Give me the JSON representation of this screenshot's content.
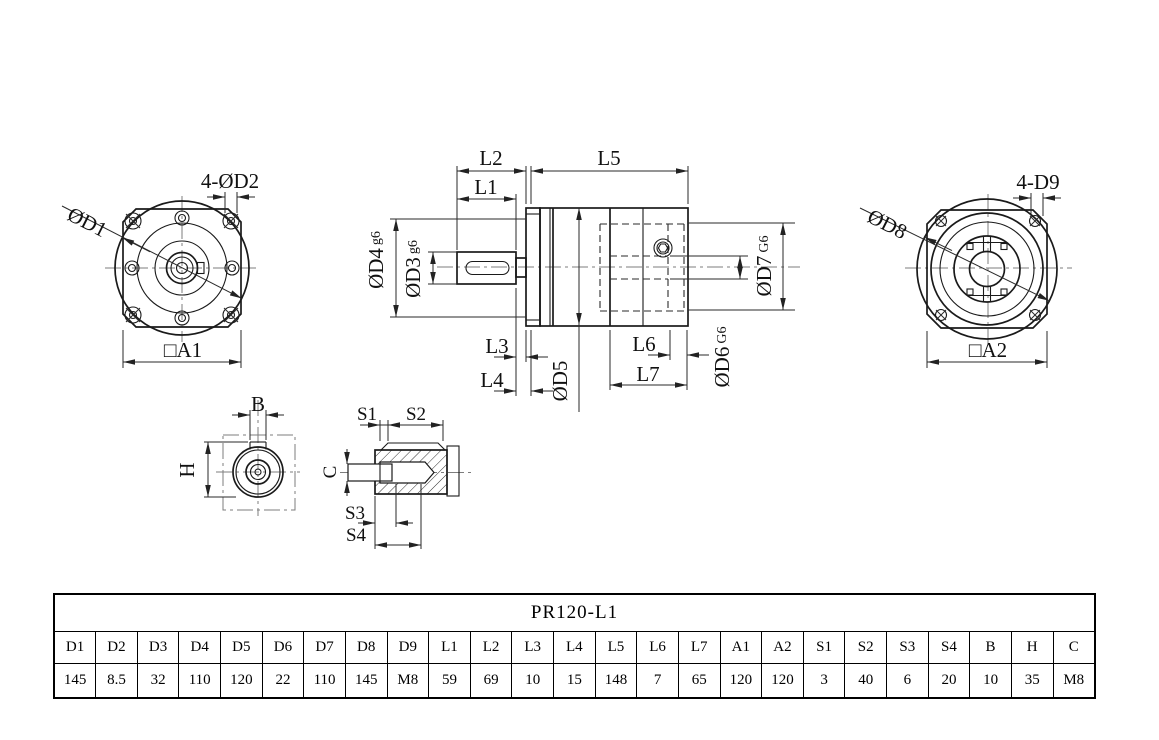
{
  "colors": {
    "line": "#1a1a1a",
    "dimension": "#2a2a2a",
    "centerline": "#7d7d7d",
    "background": "#ffffff"
  },
  "drawing": {
    "front_view": {
      "d1_label": "ØD1",
      "d2_label": "4-ØD2",
      "a1_label": "□A1"
    },
    "section_view": {
      "l1": "L1",
      "l2": "L2",
      "l3": "L3",
      "l4": "L4",
      "l5": "L5",
      "l6": "L6",
      "l7": "L7",
      "d3": "ØD3",
      "d3_fit": "g6",
      "d4": "ØD4",
      "d4_fit": "g6",
      "d5": "ØD5",
      "d6": "ØD6",
      "d6_fit": "G6",
      "d7": "ØD7",
      "d7_fit": "G6"
    },
    "rear_view": {
      "d8_label": "ØD8",
      "d9_label": "4-D9",
      "a2_label": "□A2"
    },
    "key_detail": {
      "b": "B",
      "h": "H"
    },
    "hub_detail": {
      "s1": "S1",
      "s2": "S2",
      "s3": "S3",
      "s4": "S4",
      "c": "C"
    }
  },
  "table": {
    "title": "PR120-L1",
    "headers": [
      "D1",
      "D2",
      "D3",
      "D4",
      "D5",
      "D6",
      "D7",
      "D8",
      "D9",
      "L1",
      "L2",
      "L3",
      "L4",
      "L5",
      "L6",
      "L7",
      "A1",
      "A2",
      "S1",
      "S2",
      "S3",
      "S4",
      "B",
      "H",
      "C"
    ],
    "values": [
      "145",
      "8.5",
      "32",
      "110",
      "120",
      "22",
      "110",
      "145",
      "M8",
      "59",
      "69",
      "10",
      "15",
      "148",
      "7",
      "65",
      "120",
      "120",
      "3",
      "40",
      "6",
      "20",
      "10",
      "35",
      "M8"
    ]
  }
}
